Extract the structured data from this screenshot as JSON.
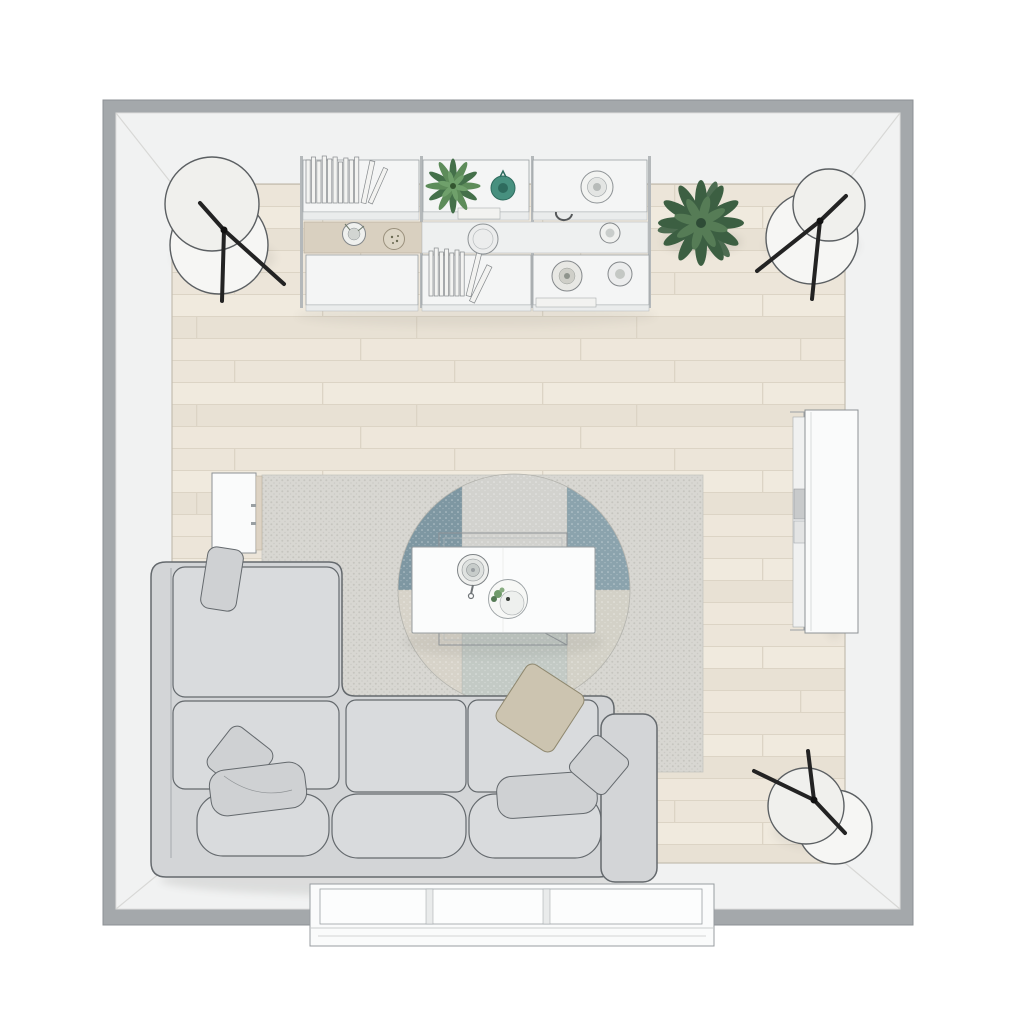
{
  "scene": {
    "type": "top-down 3d interior render",
    "room": "living-room floor plan",
    "objects": [
      "sectional-sofa",
      "coffee-table",
      "area-rug",
      "round-accent-rug",
      "wall-shelf-unit",
      "book-rows",
      "shelf-plant",
      "floor-plant",
      "teal-vase",
      "ceramic-vases-and-bowls",
      "floor-lamp-top-left",
      "floor-lamp-top-right",
      "floor-lamp-bottom-right",
      "side-table",
      "media-sideboard",
      "window-bay",
      "wood-plank-floor"
    ]
  },
  "colors": {
    "wall_outer": "#a4a8ab",
    "wall_inner": "#f1f2f2",
    "floor_a": "#ece5d9",
    "floor_b": "#f0eade",
    "floor_c": "#e8e1d4",
    "floor_d": "#eee7db",
    "plank_line": "#dcd4c5",
    "rug_base": "#d8d7d2",
    "rug_dot": "#c6c5bf",
    "blue_left": "#7e97a2",
    "blue_right": "#8ba3ad",
    "band_top": "#d2d2ce",
    "band_bottom": "#c3cac5",
    "quad_bl": "#d7d3c9",
    "quad_br": "#d3d1c7",
    "sofa": "#d3d5d7",
    "sofa_cushion": "#d9dbdd",
    "sofa_line": "#64696d",
    "pillow_gray": "#cfd1d3",
    "pillow_beige": "#ccc4b0",
    "lamp_white": "#f6f6f4",
    "lamp_leg": "#232323",
    "white": "#fafbfb",
    "shelf_white": "#f4f5f5",
    "wood_tan": "#d9d0c0",
    "green_a": "#5d8c5a",
    "green_b": "#44704a",
    "green_dark": "#3c5f42",
    "green_mid": "#567c56",
    "teal": "#47907f",
    "teal_dark": "#2e6b5e"
  }
}
